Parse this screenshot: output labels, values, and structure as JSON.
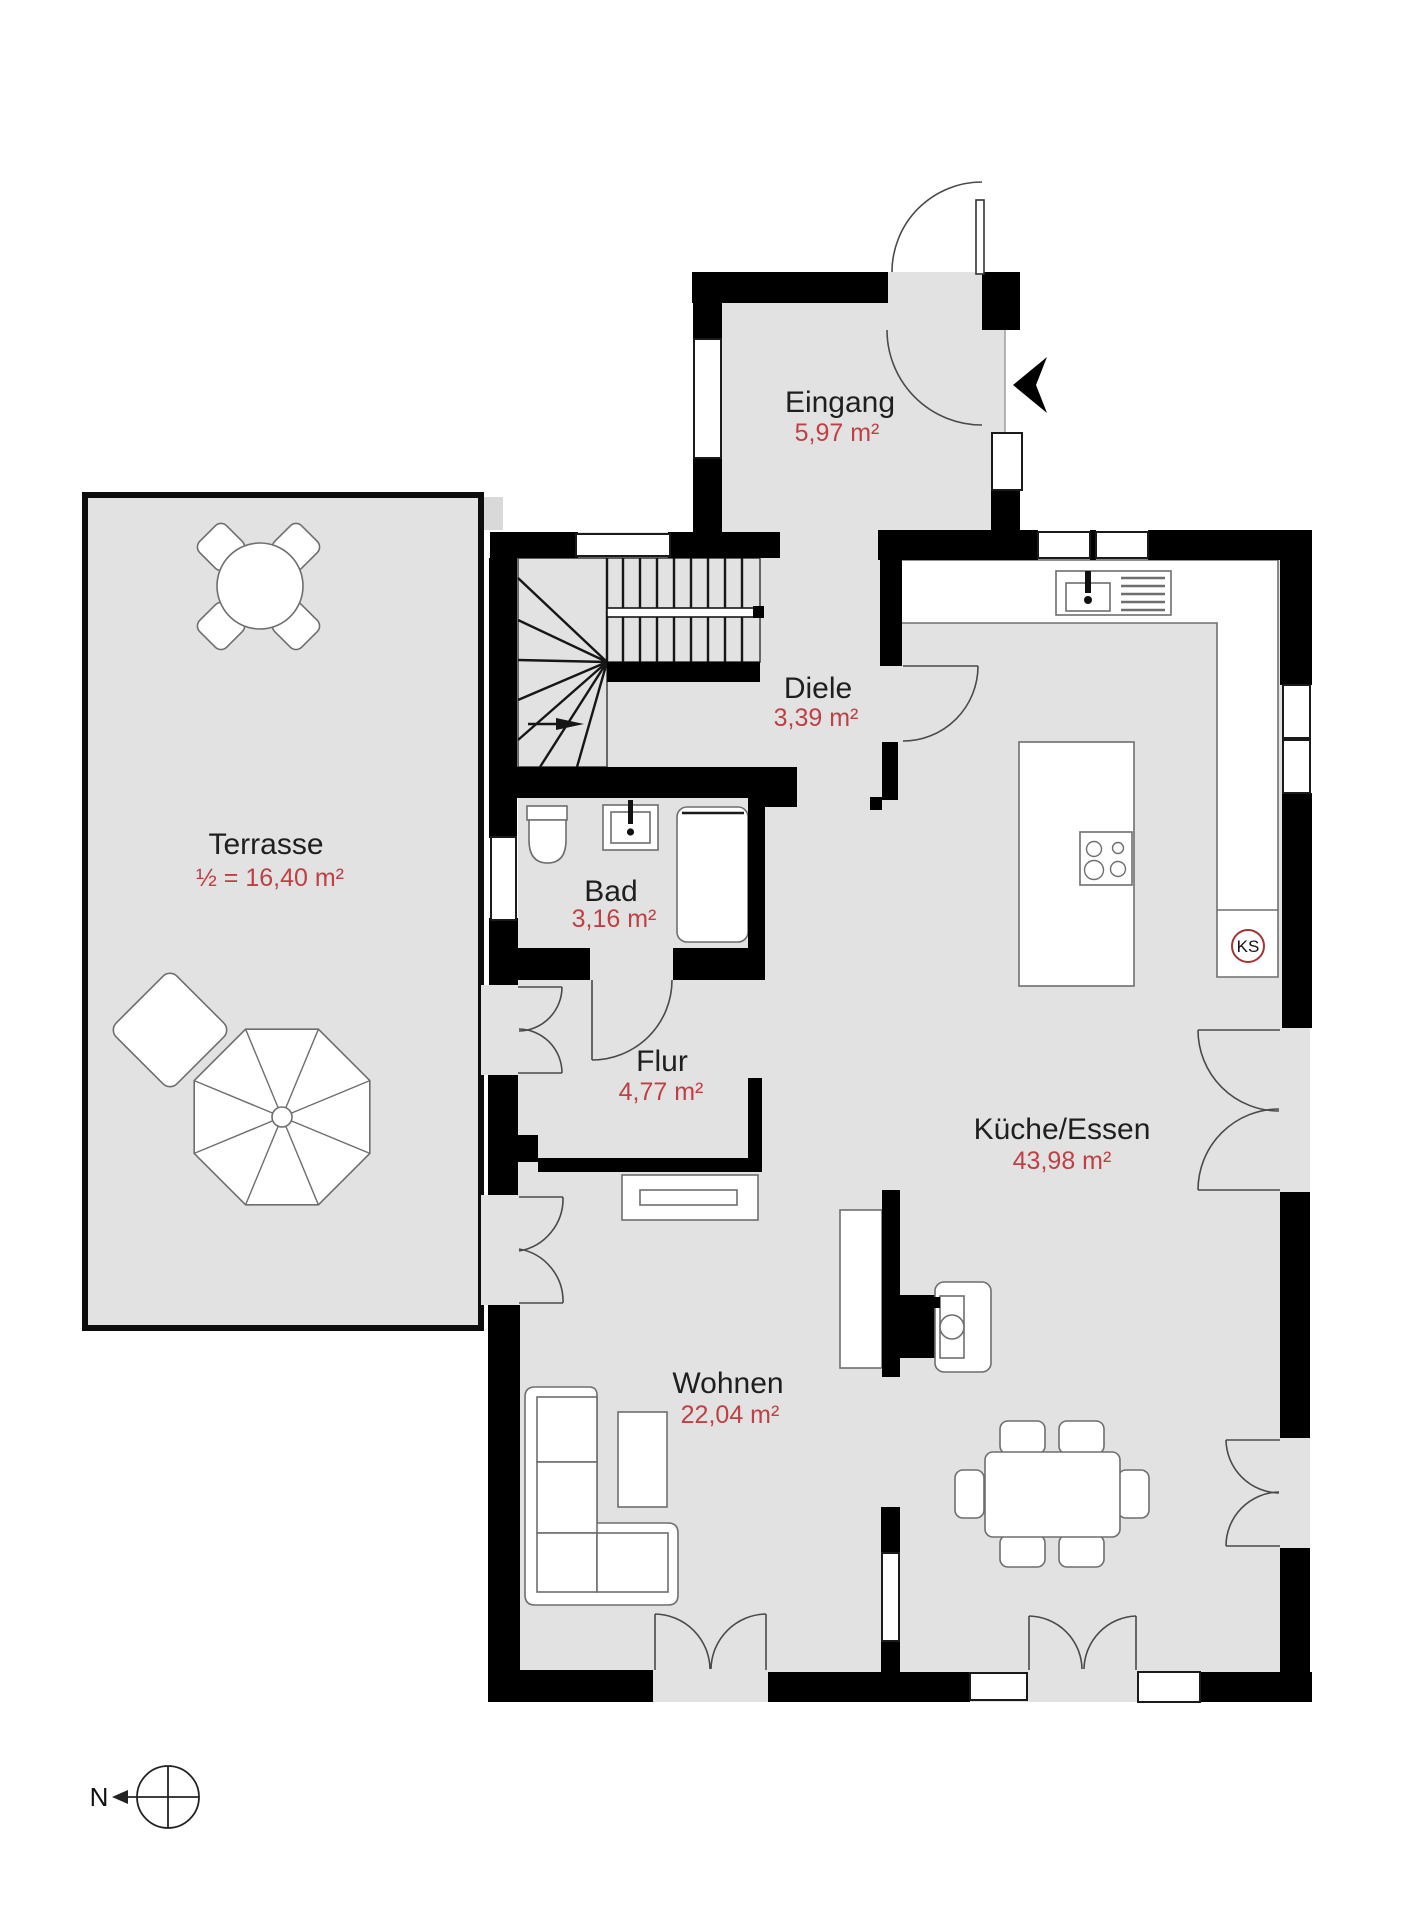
{
  "plan": {
    "rooms": {
      "terrasse": {
        "name": "Terrasse",
        "area": "½ = 16,40 m²"
      },
      "eingang": {
        "name": "Eingang",
        "area": "5,97 m²"
      },
      "diele": {
        "name": "Diele",
        "area": "3,39 m²"
      },
      "bad": {
        "name": "Bad",
        "area": "3,16 m²"
      },
      "flur": {
        "name": "Flur",
        "area": "4,77 m²"
      },
      "kueche": {
        "name": "Küche/Essen",
        "area": "43,98 m²"
      },
      "wohnen": {
        "name": "Wohnen",
        "area": "22,04 m²"
      }
    },
    "annotations": {
      "fridge_label": "KS",
      "compass_north": "N"
    },
    "colors": {
      "floor": "#e2e2e2",
      "wall": "#000000",
      "room_name_text": "#1f1f1f",
      "area_text": "#bf4043",
      "fridge_circle": "#a03534"
    }
  }
}
